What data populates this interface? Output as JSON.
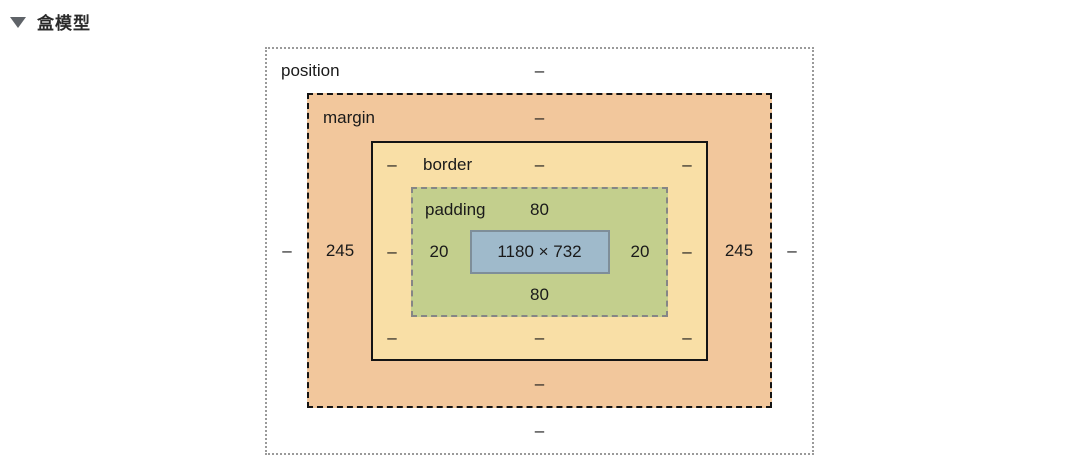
{
  "header": {
    "title": "盒模型",
    "collapse_icon": "triangle-down"
  },
  "box_model": {
    "position": {
      "label": "position",
      "top": "–",
      "left": "–",
      "right": "–",
      "bottom": "–"
    },
    "margin": {
      "label": "margin",
      "top": "–",
      "left": "245",
      "right": "245",
      "bottom": "–"
    },
    "border": {
      "label": "border",
      "top_left": "–",
      "top": "–",
      "top_right": "–",
      "left": "–",
      "right": "–",
      "bottom_left": "–",
      "bottom": "–",
      "bottom_right": "–"
    },
    "padding": {
      "label": "padding",
      "top": "80",
      "left": "20",
      "right": "20",
      "bottom": "80"
    },
    "content": {
      "size": "1180 × 732"
    }
  },
  "colors": {
    "margin-box": "#f2c79c",
    "border-box": "#f9dfa6",
    "padding-box": "#c3cf8d",
    "content-box": "#9fbacb"
  }
}
